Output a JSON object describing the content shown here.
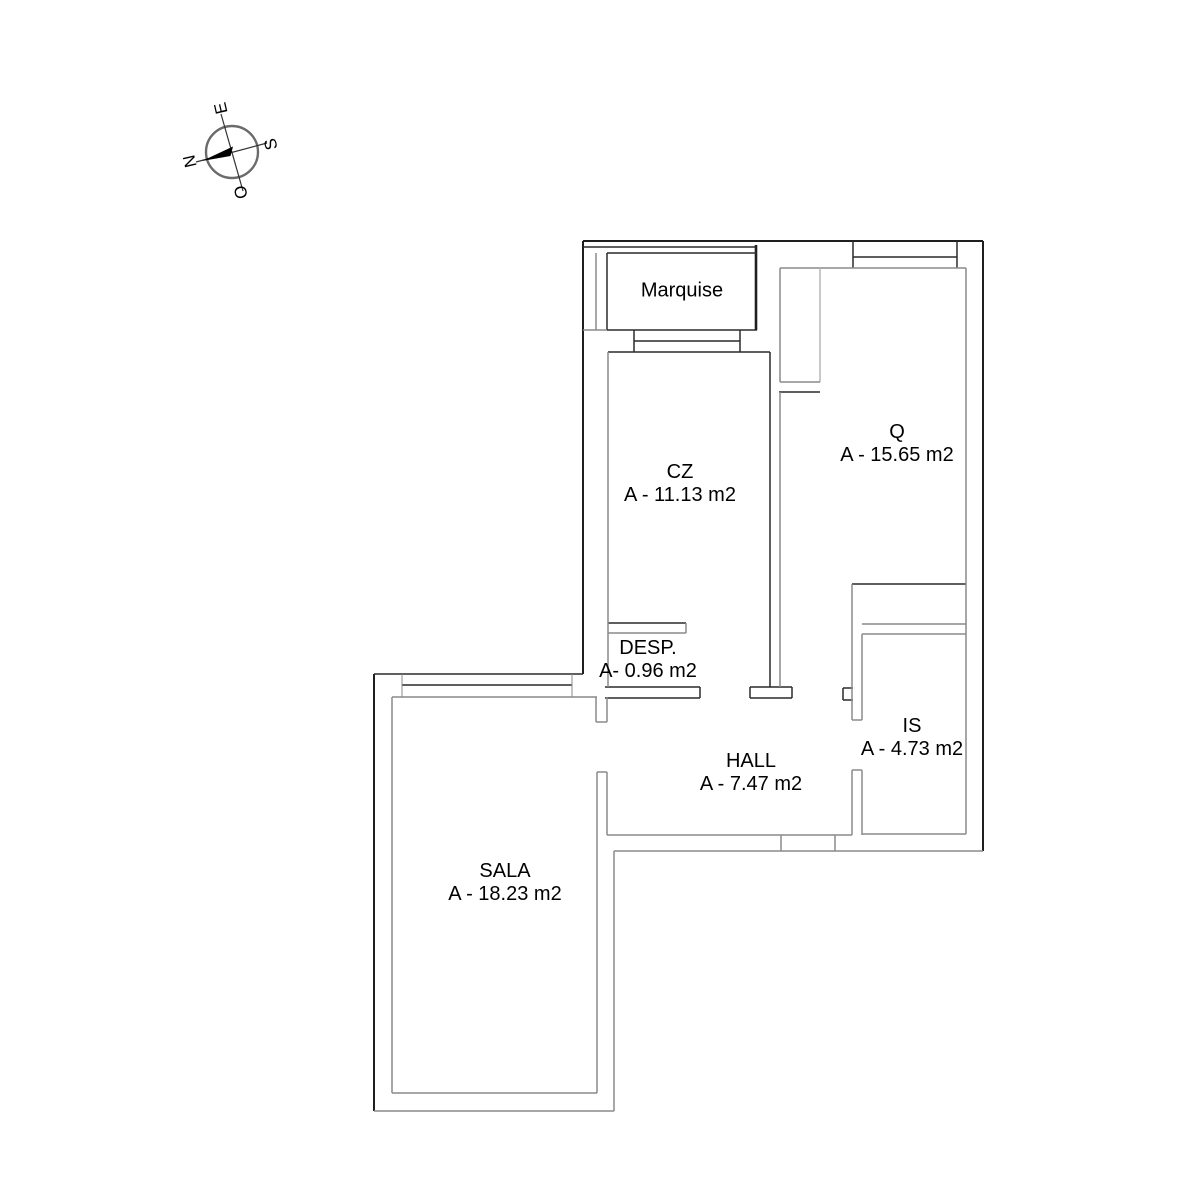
{
  "compass": {
    "north": "N",
    "south": "S",
    "east": "E",
    "west": "O"
  },
  "rooms": {
    "marquise": {
      "name": "Marquise"
    },
    "cz": {
      "name": "CZ",
      "area": "A - 11.13 m2"
    },
    "q": {
      "name": "Q",
      "area": "A - 15.65 m2"
    },
    "desp": {
      "name": "DESP.",
      "area": "A- 0.96 m2"
    },
    "hall": {
      "name": "HALL",
      "area": "A - 7.47 m2"
    },
    "is": {
      "name": "IS",
      "area": "A - 4.73 m2"
    },
    "sala": {
      "name": "SALA",
      "area": "A - 18.23 m2"
    }
  },
  "colors": {
    "background": "#ffffff",
    "wall_dark": "#1f1f1f",
    "wall_gray": "#8a8a8a",
    "needle": "#000000",
    "text": "#000000"
  }
}
